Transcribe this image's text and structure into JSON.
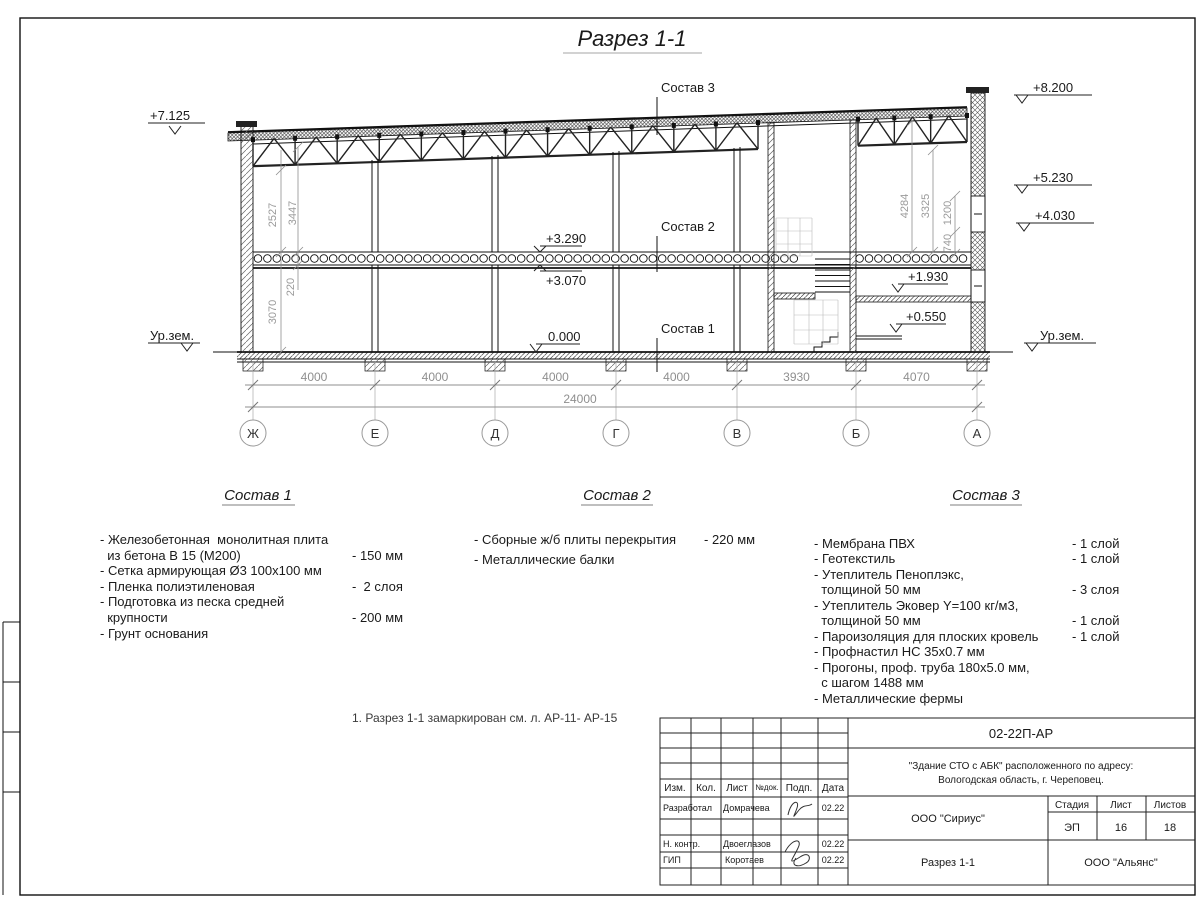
{
  "sheet": {
    "title": "Разрез 1-1",
    "note": "1. Разрез 1-1 замаркирован см. л. АР-11- АР-15"
  },
  "drawing": {
    "axes": [
      "Ж",
      "Е",
      "Д",
      "Г",
      "В",
      "Б",
      "А"
    ],
    "bay_dims": [
      "4000",
      "4000",
      "4000",
      "4000",
      "3930",
      "4070"
    ],
    "total_dim": "24000",
    "left_dims": {
      "d2527": "2527",
      "d3447": "3447",
      "d220": "220",
      "d3070": "3070"
    },
    "right_dims": {
      "d4284": "4284",
      "d3325": "3325",
      "d1200": "1200",
      "d740": "740"
    },
    "levels": {
      "l7125": "+7.125",
      "l8200": "+8.200",
      "l5230": "+5.230",
      "l4030": "+4.030",
      "l3290": "+3.290",
      "l3070": "+3.070",
      "l0000": "0.000",
      "l1930": "+1.930",
      "l0550": "+0.550",
      "ground_left": "Ур.зем.",
      "ground_right": "Ур.зем."
    },
    "callouts": {
      "c1": "Состав 1",
      "c2": "Состав 2",
      "c3": "Состав 3"
    }
  },
  "compositions": [
    {
      "title": "Состав 1",
      "rows": [
        {
          "t": "- Железобетонная  монолитная плита",
          "v": ""
        },
        {
          "t": "  из бетона В 15 (М200)",
          "v": "- 150 мм"
        },
        {
          "t": "- Сетка армирующая Ø3 100x100 мм",
          "v": ""
        },
        {
          "t": "- Пленка полиэтиленовая",
          "v": "-  2 слоя"
        },
        {
          "t": "- Подготовка из песка средней",
          "v": ""
        },
        {
          "t": "  крупности",
          "v": "- 200 мм"
        },
        {
          "t": "- Грунт основания",
          "v": ""
        }
      ]
    },
    {
      "title": "Состав 2",
      "rows": [
        {
          "t": "- Сборные ж/б плиты перекрытия",
          "v": "- 220 мм"
        },
        {
          "t": "- Металлические балки",
          "v": ""
        }
      ]
    },
    {
      "title": "Состав 3",
      "rows": [
        {
          "t": "- Мембрана ПВХ",
          "v": "- 1 слой"
        },
        {
          "t": "- Геотекстиль",
          "v": "- 1 слой"
        },
        {
          "t": "- Утеплитель Пеноплэкс,",
          "v": ""
        },
        {
          "t": "  толщиной 50 мм",
          "v": "- 3 слоя"
        },
        {
          "t": "- Утеплитель Эковер Y=100 кг/м3,",
          "v": ""
        },
        {
          "t": "  толщиной 50 мм",
          "v": "- 1 слой"
        },
        {
          "t": "- Пароизоляция для плоских кровель",
          "v": "- 1 слой"
        },
        {
          "t": "- Профнастил НС 35х0.7 мм",
          "v": ""
        },
        {
          "t": "- Прогоны, проф. труба 180х5.0 мм,",
          "v": ""
        },
        {
          "t": "  с шагом 1488 мм",
          "v": ""
        },
        {
          "t": "- Металлические фермы",
          "v": ""
        }
      ]
    }
  ],
  "titleblock": {
    "doc_number": "02-22П-АР",
    "project_line1": "\"Здание СТО с АБК\" расположенного по адресу:",
    "project_line2": "Вологодская область, г. Череповец.",
    "cols": {
      "izm": "Изм.",
      "kol": "Кол.",
      "list": "Лист",
      "ndok": "№док.",
      "podp": "Подп.",
      "data": "Дата"
    },
    "roles": {
      "r1": "Разработал",
      "r2": "Н. контр.",
      "r3": "ГИП"
    },
    "names": {
      "n1": "Домрачева",
      "n2": "Двоеглазов",
      "n3": "Коротаев"
    },
    "dates": {
      "d1": "02.22",
      "d2": "02.22",
      "d3": "02.22"
    },
    "org_design": "ООО \"Сириус\"",
    "drawing_name": "Разрез 1-1",
    "org_client": "ООО \"Альянс\"",
    "stage_label": "Стадия",
    "sheet_label": "Лист",
    "sheets_label": "Листов",
    "stage": "ЭП",
    "sheet_no": "16",
    "sheets_total": "18"
  }
}
